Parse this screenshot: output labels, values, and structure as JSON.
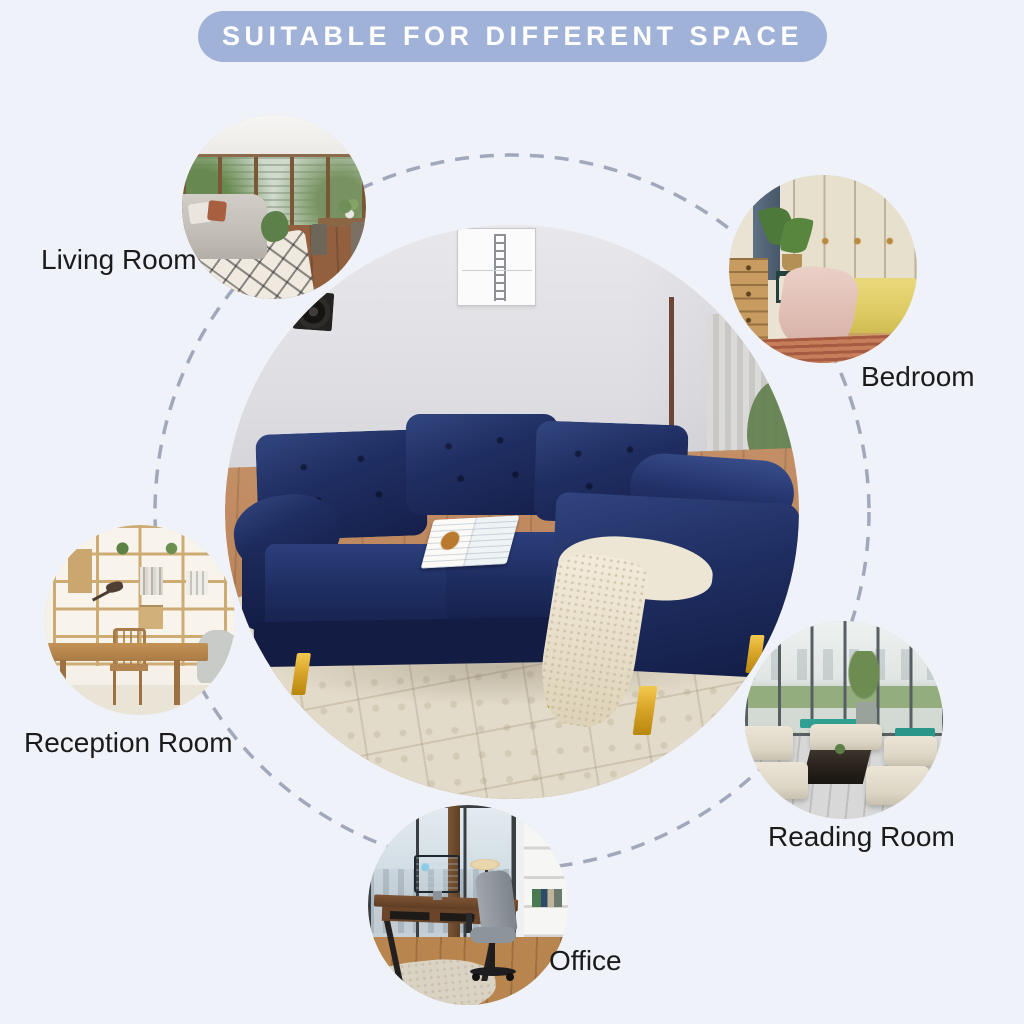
{
  "banner": {
    "label": "SUITABLE FOR DIFFERENT SPACE"
  },
  "colors": {
    "page_bg": "#eff2f8",
    "banner_bg": "#a0b2d8",
    "banner_text": "#ffffff",
    "label_text": "#1b1b1b",
    "dashed_circle": "#a2a8bb",
    "sofa_navy": "#1e2d60",
    "sofa_leg_gold": "#d9a62a",
    "rug_cream": "#e3dbc9"
  },
  "center_photo": {
    "alt": "Navy blue tufted sectional sofa with chaise and gold metal legs, cream throw blanket and open book on seat, in a room with white wall, framed ladder art print, black wall speaker, floor lamp and cream patterned rug over wood floor"
  },
  "spaces": [
    {
      "id": "living-room",
      "label": "Living Room",
      "alt": "Bright living room with wood-framed glass doors, grey sofa, patterned rug and dining table"
    },
    {
      "id": "bedroom",
      "label": "Bedroom",
      "alt": "Bedroom with cream wardrobes, yellow bedding, pink throw blanket, plants and wooden dresser"
    },
    {
      "id": "reception-room",
      "label": "Reception Room",
      "alt": "Reception room with wooden shelving wall, desk, wooden chair and grey armchair"
    },
    {
      "id": "reading-room",
      "label": "Reading Room",
      "alt": "Glass-walled lounge with cream modular sofas, dark coffee table and teal benches"
    },
    {
      "id": "office",
      "label": "Office",
      "alt": "Office with walnut desk, monitor, desk lamp, grey task chair and city-view windows"
    }
  ]
}
